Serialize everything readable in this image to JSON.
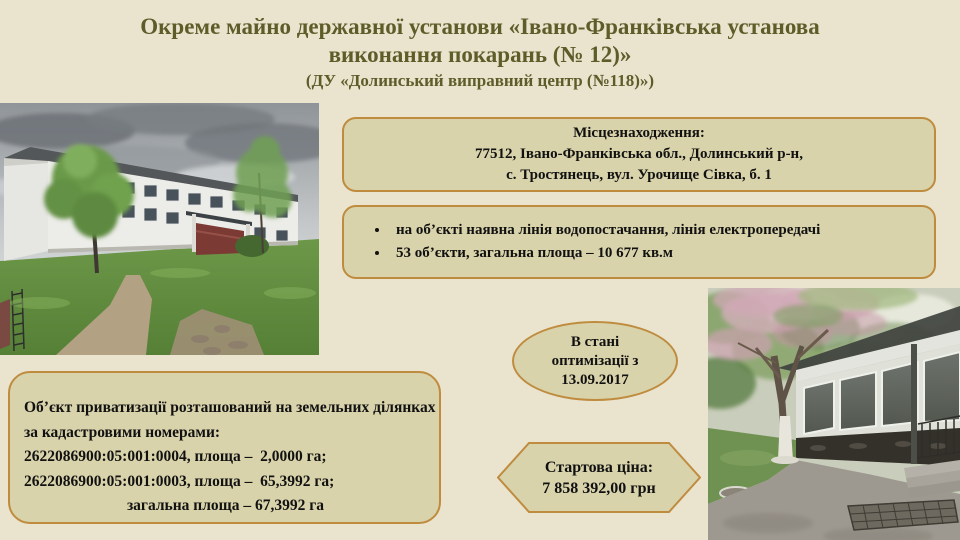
{
  "slide": {
    "title": {
      "line1": "Окреме майно державної установи «Івано-Франківська установа",
      "line2": "виконання покарань (№ 12)»",
      "subtitle": "(ДУ «Долинський виправний центр (№118)»)"
    },
    "location_box": {
      "heading": "Місцезнаходження:",
      "line1": "77512, Івано-Франківська обл., Долинський р-н,",
      "line2": "с. Тростянець, вул. Урочище Сівка, б. 1"
    },
    "features_box": {
      "items": [
        "на об’єкті наявна лінія водопостачання, лінія електропередачі",
        "53 об’єкти, загальна площа – 10 677 кв.м"
      ]
    },
    "status_ellipse": {
      "line1": "В стані",
      "line2": "оптимізації з",
      "line3": "13.09.2017"
    },
    "land_box": {
      "line1": "Об’єкт приватизації розташований на земельних ділянках",
      "line2": "за кадастровими номерами:",
      "line3": "2622086900:05:001:0004, площа –  2,0000 га;",
      "line4": "2622086900:05:001:0003, площа –  65,3992 га;",
      "line5": "загальна площа – 67,3992 га"
    },
    "price_hexagon": {
      "line1": "Стартова ціна:",
      "line2": "7 858 392,00 грн"
    },
    "colors": {
      "background": "#eae3ce",
      "panel_fill": "#d9d3ab",
      "panel_border": "#bf8c3f",
      "title_text": "#5d5d2a",
      "body_text": "#111111"
    }
  }
}
